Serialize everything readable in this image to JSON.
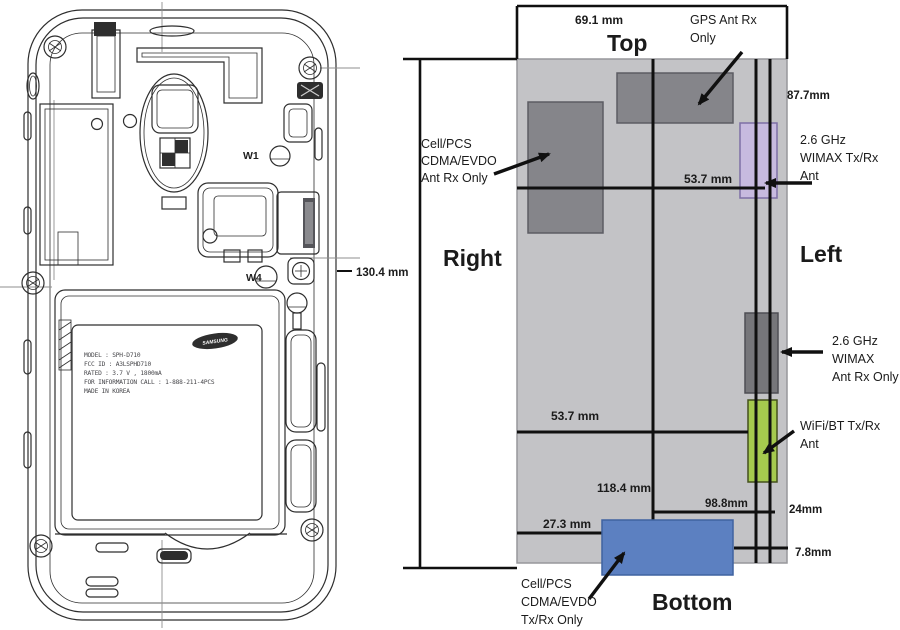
{
  "ann": {
    "top_width": "69.1 mm",
    "side_top": "Top",
    "gps": [
      "GPS Ant Rx",
      "Only"
    ],
    "offset_877": "87.7mm",
    "cell_rx": [
      "Cell/PCS",
      "CDMA/EVDO",
      "Ant Rx Only"
    ],
    "wimax_tx": [
      "2.6 GHz",
      "WIMAX Tx/Rx",
      "Ant"
    ],
    "dim_537_upper": "53.7 mm",
    "height": "130.4 mm",
    "side_right": "Right",
    "side_left": "Left",
    "wimax_rx": [
      "2.6 GHz",
      "WIMAX",
      "Ant Rx Only"
    ],
    "dim_537_lower": "53.7 mm",
    "wifi": [
      "WiFi/BT Tx/Rx",
      "Ant"
    ],
    "dim_1184": "118.4 mm",
    "dim_988": "98.8mm",
    "dim_24": "24mm",
    "dim_273": "27.3 mm",
    "dim_78": "7.8mm",
    "cell_tx": [
      "Cell/PCS",
      "CDMA/EVDO",
      "Tx/Rx Only"
    ],
    "side_bottom": "Bottom"
  },
  "phone": {
    "brand": "SAMSUNG",
    "ref_w1": "W1",
    "ref_w4": "W4",
    "battery_label": [
      "MODEL : SPH-D710",
      "FCC ID : A3LSPHD710",
      "RATED : 3.7 V , 1800mA",
      "FOR INFORMATION CALL : 1-888-211-4PCS",
      "MADE IN KOREA"
    ]
  },
  "colors": {
    "body_gray": "#c3c3c6",
    "antenna_dark": "#85858a",
    "antenna_darker": "#76767a",
    "wimax_purple": "#c7badf",
    "wifi_green": "#a5ca4e",
    "cell_blue": "#5c80c1"
  }
}
